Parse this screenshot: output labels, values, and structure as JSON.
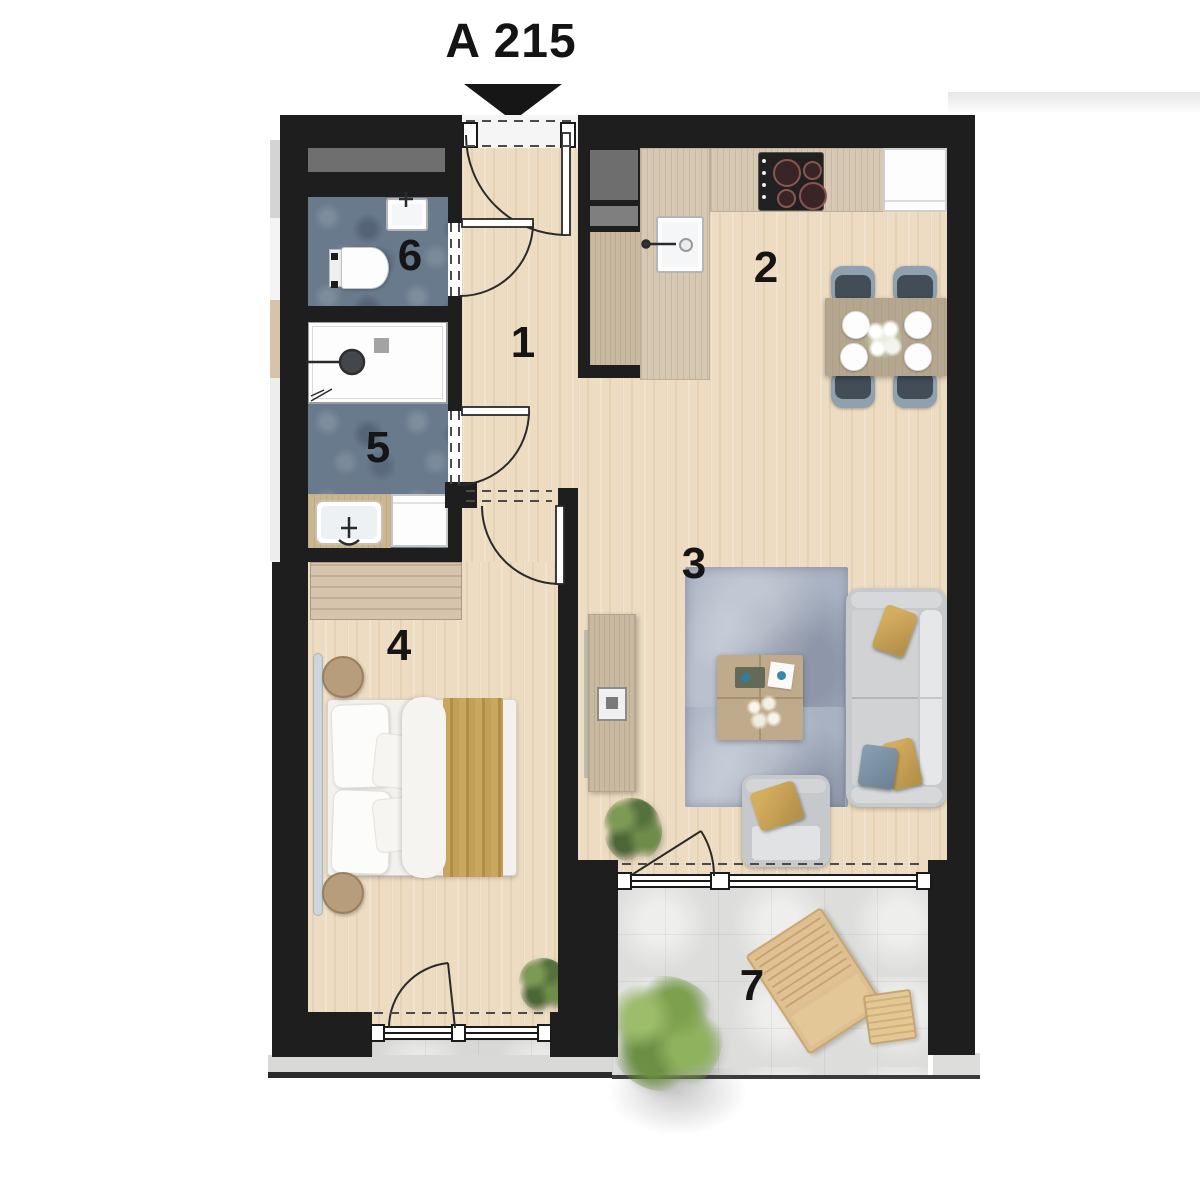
{
  "title": "A 215",
  "rooms": [
    {
      "number": "1"
    },
    {
      "number": "2"
    },
    {
      "number": "3"
    },
    {
      "number": "4"
    },
    {
      "number": "5"
    },
    {
      "number": "6"
    },
    {
      "number": "7"
    }
  ],
  "legend": {
    "marker": "entrance-arrow",
    "room_objects": {
      "1": [
        "hall-floor"
      ],
      "2": [
        "kitchen-counter",
        "cooktop",
        "kitchen-sink",
        "fridge",
        "dining-table",
        "dining-chairs"
      ],
      "3": [
        "rug",
        "sofa",
        "armchair",
        "coffee-table",
        "tv-sideboard",
        "potted-plant"
      ],
      "4": [
        "double-bed",
        "nightstands",
        "wardrobe",
        "potted-plant"
      ],
      "5": [
        "shower",
        "vanity-sink",
        "washing-machine"
      ],
      "6": [
        "wc-sink",
        "toilet"
      ],
      "7": [
        "lounge-chair",
        "side-table",
        "shrub"
      ]
    }
  },
  "palette": {
    "wall": "#1e1e1e",
    "wood_floor": "#eddcc1",
    "counter_wood": "#d6c8b2",
    "bath_tile": "#697a8c",
    "rug": "#a9b2c2",
    "balcony_concrete": "#dddddb",
    "accent_mustard": "#c8a254",
    "chair_slate": "#424d58",
    "sofa_gray": "#c7cacc",
    "plant_green": "#6d8a4c"
  }
}
